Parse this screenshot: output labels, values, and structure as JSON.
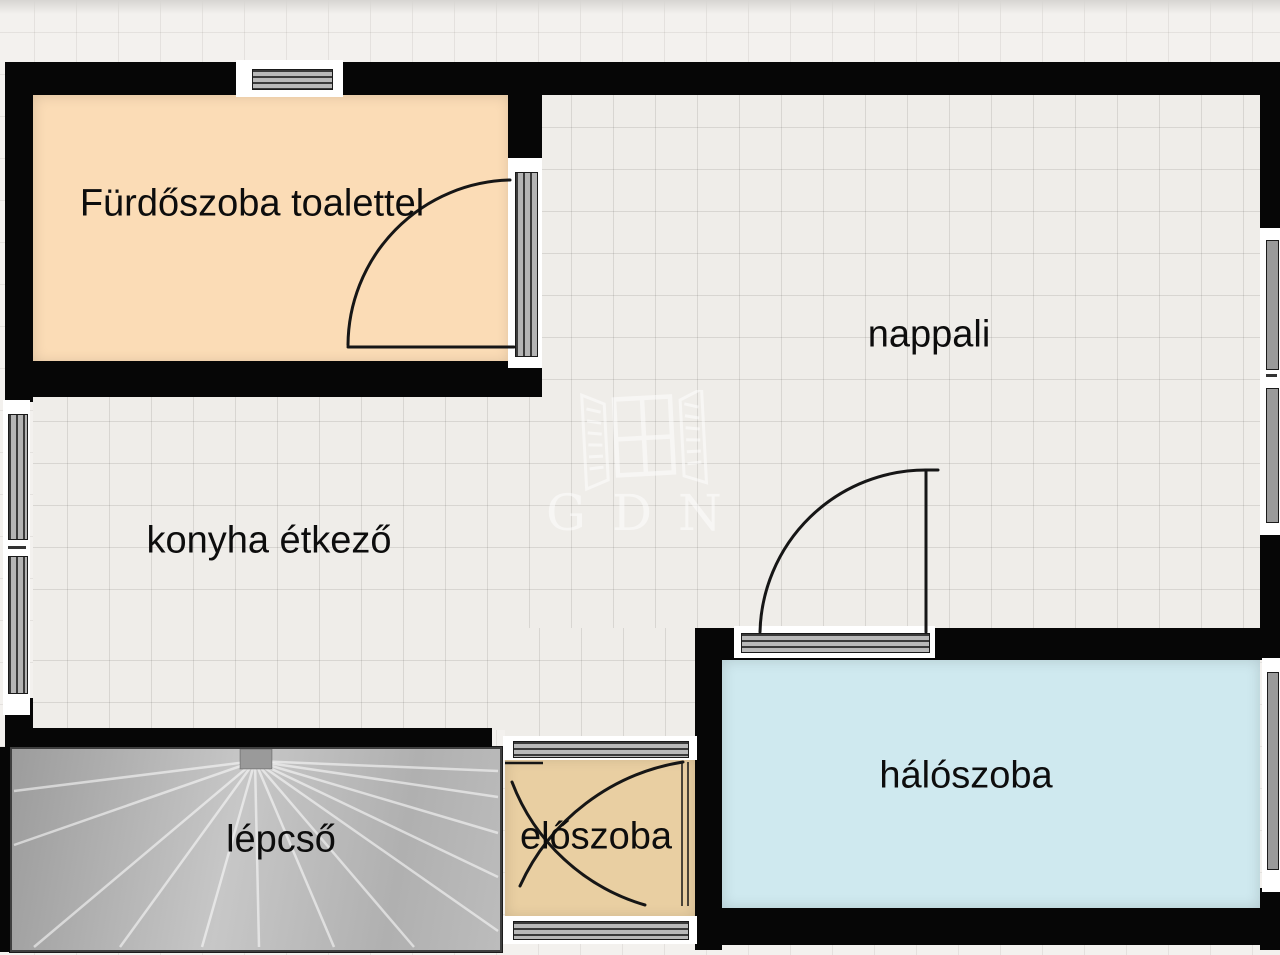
{
  "plan": {
    "title": "floor-plan",
    "watermark": {
      "text": "GDN",
      "color": "#ffffff"
    },
    "rooms": [
      {
        "id": "bathroom",
        "label": "Fürdőszoba toalettel",
        "fill": "#fbdcb6"
      },
      {
        "id": "living",
        "label": "nappali",
        "fill": "#efede9"
      },
      {
        "id": "kitchen",
        "label": "konyha étkező",
        "fill": "#efede9"
      },
      {
        "id": "bedroom",
        "label": "hálószoba",
        "fill": "#cfe9ef"
      },
      {
        "id": "hall",
        "label": "előszoba",
        "fill": "#e9cfa2"
      },
      {
        "id": "stairs",
        "label": "lépcső",
        "fill": "#b5b5b5"
      }
    ],
    "colors": {
      "wall": "#060606",
      "floor": "#efede9",
      "outside": "#f3f1ee",
      "door_arc": "#161616",
      "window_frame": "#ffffff",
      "window_glass": "#9a9a9a"
    }
  }
}
